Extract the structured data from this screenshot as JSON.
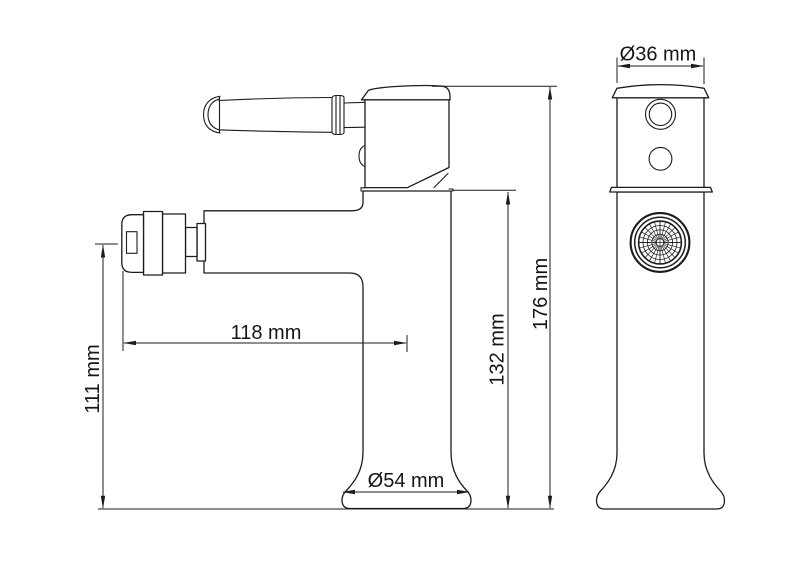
{
  "drawing": {
    "type": "technical-dimension-drawing",
    "subject": "single-lever faucet, side and front orthographic views",
    "colors": {
      "line": "#1c1c1c",
      "background": "#ffffff"
    },
    "dimensions": [
      {
        "id": "spout-diameter",
        "label": "Ø36 mm"
      },
      {
        "id": "total-height",
        "label": "176 mm"
      },
      {
        "id": "body-height",
        "label": "132 mm"
      },
      {
        "id": "spout-height",
        "label": "111 mm"
      },
      {
        "id": "spout-reach",
        "label": "118 mm"
      },
      {
        "id": "base-diameter",
        "label": "Ø54 mm"
      }
    ]
  }
}
